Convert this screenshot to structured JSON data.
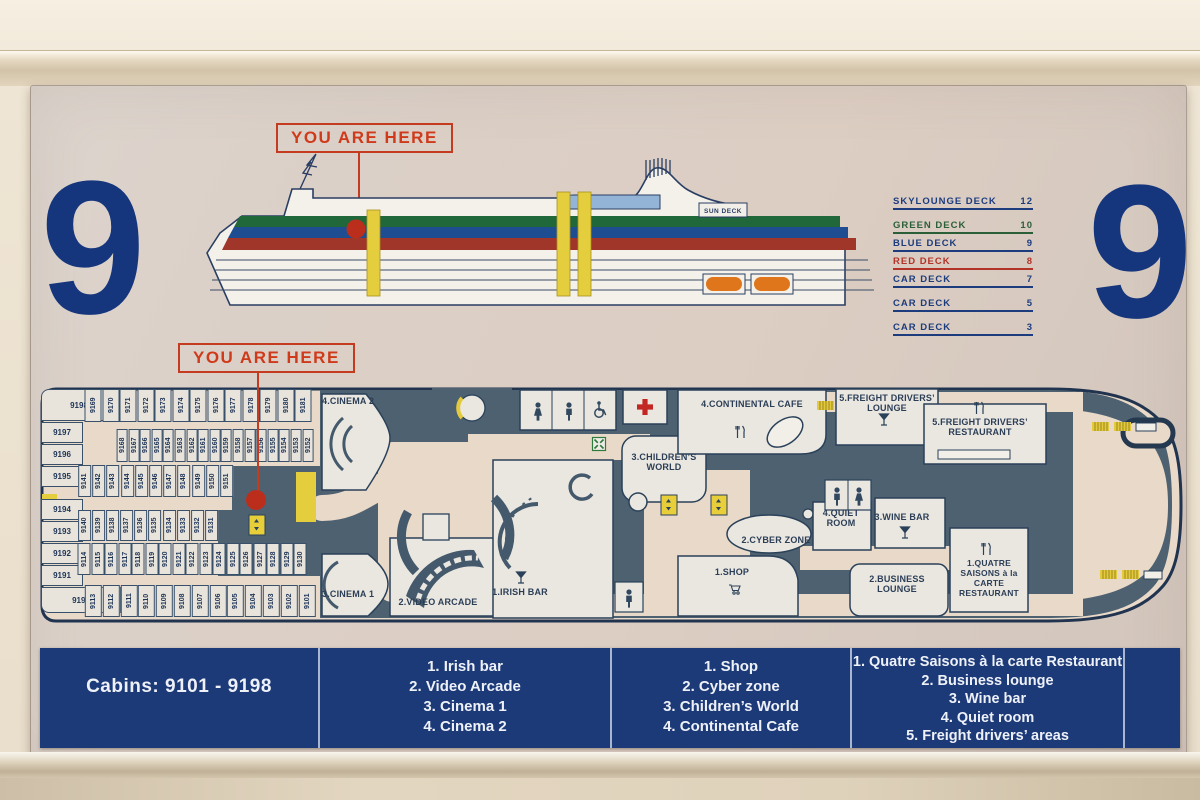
{
  "deck_number": "9",
  "you_are_here_label": "YOU ARE HERE",
  "ship_profile": {
    "sun_deck_label": "SUN DECK",
    "deck_legend_header": {
      "label": "SKYLOUNGE DECK",
      "number": "12"
    },
    "deck_legend_rows": [
      {
        "label": "GREEN DECK",
        "number": "10",
        "color": "#2a5f38"
      },
      {
        "label": "BLUE DECK",
        "number": "9",
        "color": "#1c3c7e"
      },
      {
        "label": "RED DECK",
        "number": "8",
        "color": "#b23428"
      },
      {
        "label": "CAR DECK",
        "number": "7",
        "color": "#1c3c7e"
      },
      {
        "label": "CAR DECK",
        "number": "5",
        "color": "#1c3c7e"
      },
      {
        "label": "CAR DECK",
        "number": "3",
        "color": "#1c3c7e"
      }
    ]
  },
  "floor_plan": {
    "labels": {
      "cinema2": "4.CINEMA 2",
      "cinema1": "3.CINEMA 1",
      "video_arcade": "2.VIDEO ARCADE",
      "irish_bar": "1.IRISH BAR",
      "childrens_world": "3.CHILDREN’S WORLD",
      "continental_cafe": "4.CONTINENTAL CAFE",
      "cyber_zone": "2.CYBER ZONE",
      "shop": "1.SHOP",
      "quiet_room": "4.QUIET ROOM",
      "wine_bar": "3.WINE BAR",
      "business_lounge": "2.BUSINESS LOUNGE",
      "freight_drivers_lounge": "5.FREIGHT DRIVERS’ LOUNGE",
      "freight_drivers_restaurant": "5.FREIGHT DRIVERS’ RESTAURANT",
      "quatre_saisons": "1.QUATRE SAISONS à la CARTE RESTAURANT"
    },
    "cabins": {
      "left_column": [
        "9198",
        "9197",
        "9196",
        "9195",
        "9194",
        "9193",
        "9192",
        "9191",
        "9190"
      ],
      "row_a": [
        "9169",
        "9170",
        "9171",
        "9172",
        "9173",
        "9174",
        "9175",
        "9176",
        "9177",
        "9178",
        "9179",
        "9180",
        "9181"
      ],
      "row_b": [
        "9168",
        "9167",
        "9166",
        "9165",
        "9164",
        "9163",
        "9162",
        "9161",
        "9160",
        "9159",
        "9158",
        "9157",
        "9156",
        "9155",
        "9154",
        "9153",
        "9152"
      ],
      "row_c": [
        "9141",
        "9142",
        "9143",
        "9144",
        "9145",
        "9146",
        "9147",
        "9148",
        "9149",
        "9150",
        "9151"
      ],
      "row_d": [
        "9140",
        "9139",
        "9138",
        "9137",
        "9136",
        "9135",
        "9134",
        "9133",
        "9132",
        "9131"
      ],
      "row_e": [
        "9114",
        "9115",
        "9116",
        "9117",
        "9118",
        "9119",
        "9120",
        "9121",
        "9122",
        "9123",
        "9124",
        "9125",
        "9126",
        "9127",
        "9128",
        "9129",
        "9130"
      ],
      "row_f": [
        "9113",
        "9112",
        "9111",
        "9110",
        "9109",
        "9108",
        "9107",
        "9106",
        "9105",
        "9104",
        "9103",
        "9102",
        "9101"
      ]
    }
  },
  "legend": {
    "panels": [
      {
        "lines": [
          "Cabins: 9101 - 9198"
        ]
      },
      {
        "lines": [
          "1. Irish bar",
          "2. Video Arcade",
          "3. Cinema 1",
          "4. Cinema 2"
        ]
      },
      {
        "lines": [
          "1. Shop",
          "2. Cyber zone",
          "3. Children’s World",
          "4. Continental Cafe"
        ]
      },
      {
        "lines": [
          "1. Quatre Saisons à la carte Restaurant",
          "2. Business lounge",
          "3. Wine bar",
          "4. Quiet room",
          "5. Freight drivers’ areas"
        ]
      }
    ]
  },
  "colors": {
    "navy": "#1c3c7e",
    "red_accent": "#c43b1f",
    "plan_dark": "#4e6170",
    "corridor_pink": "#e9d9c9",
    "room_white": "#eae7e1",
    "highlight_yellow": "#e5ce3d",
    "stripe_green": "#20673a",
    "stripe_blue": "#1e4d92",
    "stripe_red": "#a03529",
    "lifeboat_orange": "#e0761c",
    "legend_bar_blue": "#1d3a78"
  }
}
